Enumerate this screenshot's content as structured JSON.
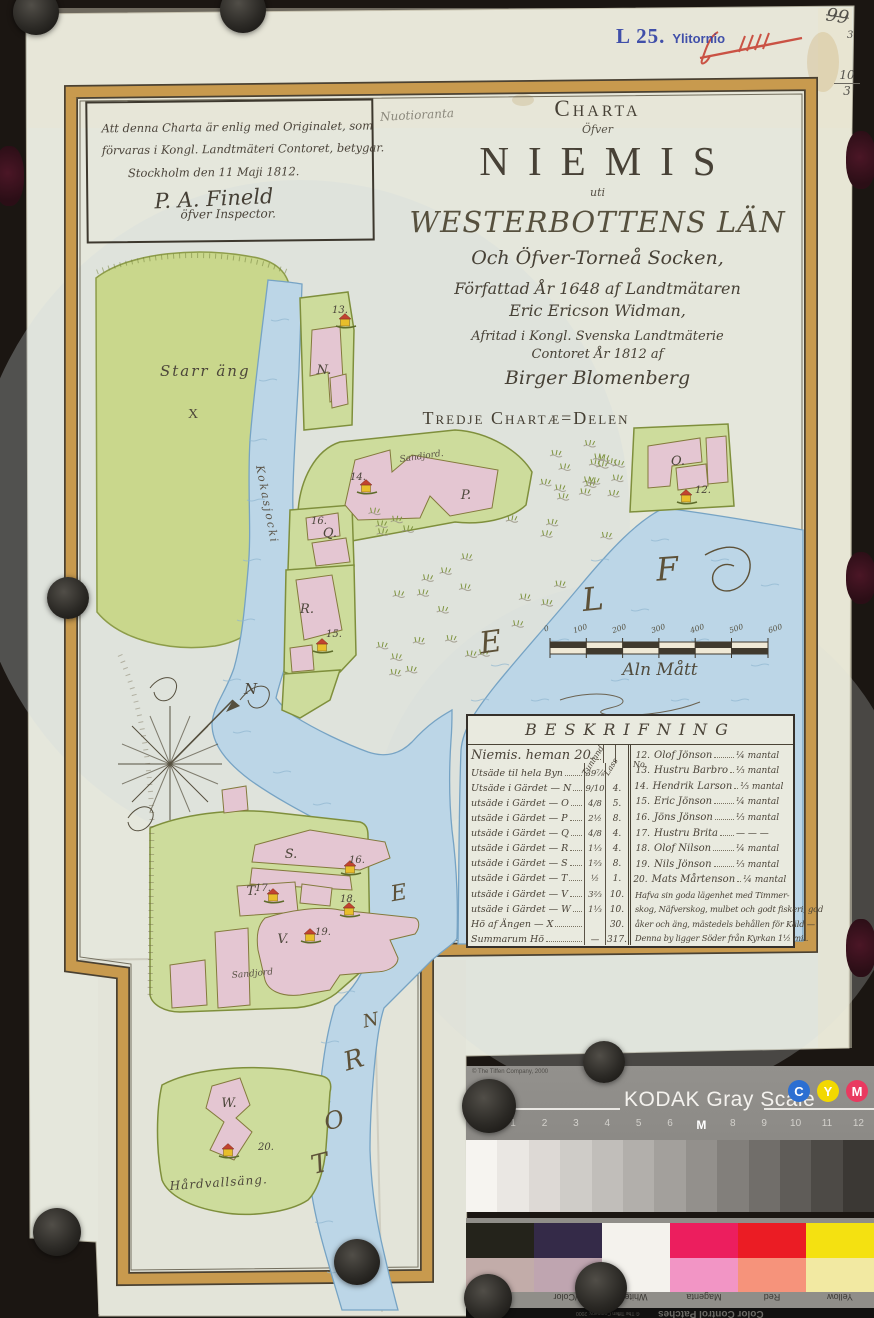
{
  "photo": {
    "stamp_code": "L 25.",
    "stamp_place": "Ylitornio",
    "page_number": "99",
    "page_number_sub": "3",
    "fraction_top": "10",
    "fraction_bottom": "3",
    "pencil_note": "Nuotioranta"
  },
  "attestation": {
    "line1": "Att denna Charta är enlig med Originalet, som",
    "line2": "förvaras i Kongl. Landtmäteri Contoret, betygar.",
    "line3": "Stockholm den 11 Maji 1812.",
    "signature": "P. A. Fineld",
    "sig_title": "öfver Inspector."
  },
  "title": {
    "charta": "Charta",
    "ofver": "Öfver",
    "name": "NIEMIS",
    "uti": "uti",
    "county": "WESTERBOTTENS LÄN",
    "parish": "Och Öfver-Torneå Socken,",
    "made1": "Författad År 1648 af Landtmätaren",
    "made2": "Eric Ericson Widman,",
    "copy1": "Afritad i Kongl. Svenska Landtmäterie",
    "copy2": "Contoret År 1812 af",
    "copy3": "Birger Blomenberg"
  },
  "section_heading": "Tredje Chartæ=Delen",
  "map": {
    "meadow_label": "Starr äng",
    "meadow_letter": "X",
    "river_label": "Kokasjocki",
    "sandjord_p": "Sandjord.",
    "sandjord_v": "Sandjord",
    "hardvall_label": "Hårdvallsäng.",
    "compass_n": "N",
    "parcels": {
      "N": "N.",
      "O": "O.",
      "P": "P.",
      "Q": "Q.",
      "R": "R.",
      "S": "S.",
      "T": "T.",
      "V": "V.",
      "W": "W."
    },
    "numbers": {
      "n12": "12.",
      "n13": "13.",
      "n14": "14.",
      "n15": "15.",
      "n16": "16.",
      "n16q": "16.",
      "n17": "17.",
      "n18": "18.",
      "n19": "19.",
      "n20": "20."
    },
    "elf": [
      "E",
      "L",
      "F"
    ],
    "torne": [
      "T",
      "O",
      "R",
      "N",
      "E"
    ]
  },
  "scale": {
    "ticks": [
      "0",
      "100",
      "200",
      "300",
      "400",
      "500",
      "600"
    ],
    "caption": "Aln Mått"
  },
  "table": {
    "heading": "BESKRIFNING",
    "col1_header": "Tunland",
    "col2_header": "Lass",
    "no_header": "No.",
    "left_rows": [
      {
        "label": "Niemis. heman 20.",
        "v1": "",
        "v2": ""
      },
      {
        "label": "Utsäde til hela Byn",
        "v1": "39⅞",
        "v2": ""
      },
      {
        "label": "Utsäde i Gärdet — N",
        "v1": "9/10",
        "v2": "4."
      },
      {
        "label": "utsäde i Gärdet — O",
        "v1": "4/8",
        "v2": "5."
      },
      {
        "label": "utsäde i Gärdet — P",
        "v1": "2½",
        "v2": "8."
      },
      {
        "label": "utsäde i Gärdet — Q",
        "v1": "4/8",
        "v2": "4."
      },
      {
        "label": "utsäde i Gärdet — R",
        "v1": "1⅓",
        "v2": "4."
      },
      {
        "label": "utsäde i Gärdet — S",
        "v1": "1⅔",
        "v2": "8."
      },
      {
        "label": "utsäde i Gärdet — T",
        "v1": "½",
        "v2": "1."
      },
      {
        "label": "utsäde i Gärdet — V",
        "v1": "3⅔",
        "v2": "10."
      },
      {
        "label": "utsäde i Gärdet — W",
        "v1": "1⅓",
        "v2": "10."
      },
      {
        "label": "Hö af Ängen — X",
        "v1": "",
        "v2": "30."
      },
      {
        "label": "Summarum Hö",
        "v1": "—",
        "v2": "317."
      }
    ],
    "right_rows": [
      {
        "no": "12.",
        "name": "Olof Jönson",
        "share": "¼ mantal"
      },
      {
        "no": "13.",
        "name": "Hustru Barbro",
        "share": "⅓ mantal"
      },
      {
        "no": "14.",
        "name": "Hendrik Larson",
        "share": "⅓ mantal"
      },
      {
        "no": "15.",
        "name": "Eric Jönson",
        "share": "¼ mantal"
      },
      {
        "no": "16.",
        "name": "Jöns Jönson",
        "share": "⅓ mantal"
      },
      {
        "no": "17.",
        "name": "Hustru Brita",
        "share": "— — —"
      },
      {
        "no": "18.",
        "name": "Olof Nilson",
        "share": "¼ mantal"
      },
      {
        "no": "19.",
        "name": "Nils Jönson",
        "share": "⅓ mantal"
      },
      {
        "no": "20.",
        "name": "Mats Mårtenson",
        "share": "¼ mantal"
      }
    ],
    "notes": [
      "Hafva sin goda lägenhet med Timmer-",
      "skog, Näfverskog, mulbet och godt fiskeri, god",
      "åker och äng, mästedels behållen för Käld —",
      "Denna by ligger Söder från Kyrkan 1½ mil."
    ]
  },
  "kodak": {
    "copyright": "© The Tiffen Company, 2000",
    "title": "KODAK Gray Scale",
    "c": "C",
    "y": "Y",
    "m": "M",
    "c_color": "#2c6fd2",
    "y_color": "#f2d801",
    "m_color": "#e93a60",
    "steps": [
      "A",
      "1",
      "2",
      "3",
      "4",
      "5",
      "6",
      "M",
      "8",
      "9",
      "10",
      "11",
      "12"
    ],
    "grays": [
      "#f6f4f0",
      "#eae7e3",
      "#ddd9d5",
      "#cfccc8",
      "#c1beba",
      "#b2afab",
      "#a3a09c",
      "#93908c",
      "#827f7b",
      "#716e6a",
      "#5f5c58",
      "#4d4a46",
      "#3b3834"
    ]
  },
  "color_card": {
    "title": "Color Control Patches",
    "copyright": "© The Tiffen Company, 2000",
    "patches": [
      {
        "label": "Black",
        "top": "#24231b",
        "bottom": "#c2aca9"
      },
      {
        "label": "3/Color",
        "top": "#342a48",
        "bottom": "#bfa5b0"
      },
      {
        "label": "White",
        "top": "#f4f2ed",
        "bottom": "#f4f2ed"
      },
      {
        "label": "Magenta",
        "top": "#ec1e5e",
        "bottom": "#f295c5"
      },
      {
        "label": "Red",
        "top": "#eb1c24",
        "bottom": "#f6937b"
      },
      {
        "label": "Yellow",
        "top": "#f4e111",
        "bottom": "#f2e9a2"
      }
    ]
  }
}
